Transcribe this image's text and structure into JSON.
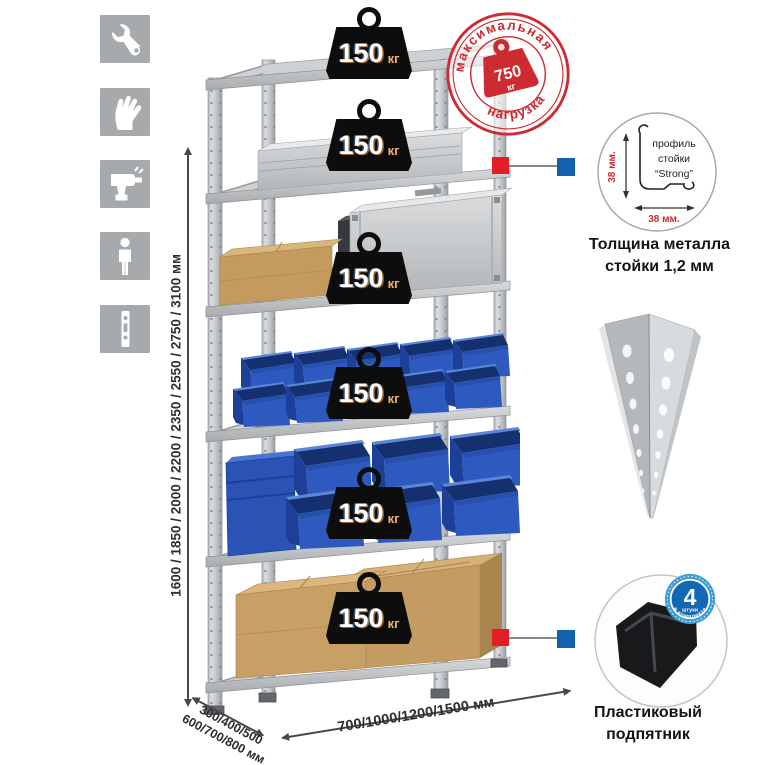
{
  "sidebar": {
    "icons": [
      {
        "id": "wrench"
      },
      {
        "id": "gloves"
      },
      {
        "id": "drill"
      },
      {
        "id": "person"
      },
      {
        "id": "rack-post"
      }
    ]
  },
  "dimensions": {
    "height": "1600 / 1850 / 2000 / 2200 / 2350 / 2550 / 2750 / 3100 мм",
    "depth_line1": "300/400/500",
    "depth_line2": "600/700/800 мм",
    "width": "700/1000/1200/1500 мм"
  },
  "shelves": [
    {
      "value": "150",
      "unit": "кг"
    },
    {
      "value": "150",
      "unit": "кг"
    },
    {
      "value": "150",
      "unit": "кг"
    },
    {
      "value": "150",
      "unit": "кг"
    },
    {
      "value": "150",
      "unit": "кг"
    },
    {
      "value": "150",
      "unit": "кг"
    }
  ],
  "stamp": {
    "arc_top": "максимальная",
    "arc_bottom": "нагрузка",
    "value": "750",
    "unit": "кг"
  },
  "profile": {
    "label_line1": "профиль",
    "label_line2": "стойки",
    "label_line3": "“Strong”",
    "dim_vertical": "38 мм.",
    "dim_horizontal": "38 мм.",
    "caption_line1": "Толщина металла",
    "caption_line2": "стойки 1,2 мм"
  },
  "foot": {
    "badge_value": "4",
    "badge_word": "штуки",
    "badge_arc": "в комплекте",
    "caption_line1": "Пластиковый",
    "caption_line2": "подпятник"
  },
  "colors": {
    "stamp_red": "#cd2b31",
    "callout_red": "#e31e24",
    "callout_blue": "#1261b0",
    "bin_blue": "#2e5ac0",
    "icon_gray": "#a7aaad"
  }
}
